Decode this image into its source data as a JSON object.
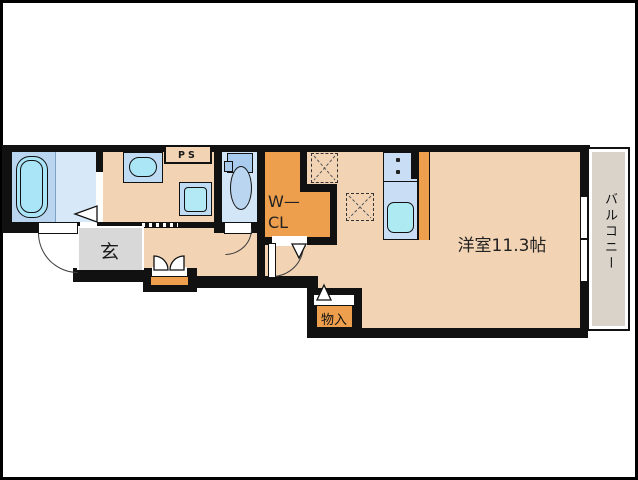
{
  "rooms": {
    "main_room": {
      "label": "洋室11.3帖"
    },
    "balcony": {
      "label": "バルコニー"
    },
    "entrance": {
      "label": "玄"
    },
    "walk_in_closet": {
      "line1": "W—",
      "line2": "CL"
    },
    "storage": {
      "label": "物入"
    },
    "pipe_space": {
      "label": "PS"
    }
  },
  "colors": {
    "wall": "#111111",
    "floor_tan": "#f2d4b5",
    "accent_orange": "#ee9f4e",
    "entrance_gray": "#d8d8d8",
    "balcony_gray": "#d9d3ca",
    "bath_floor_blue": "#b9d5ef",
    "water_fixture_blue": "#c0dbf4",
    "sink_cyan": "#a9e4f7"
  }
}
